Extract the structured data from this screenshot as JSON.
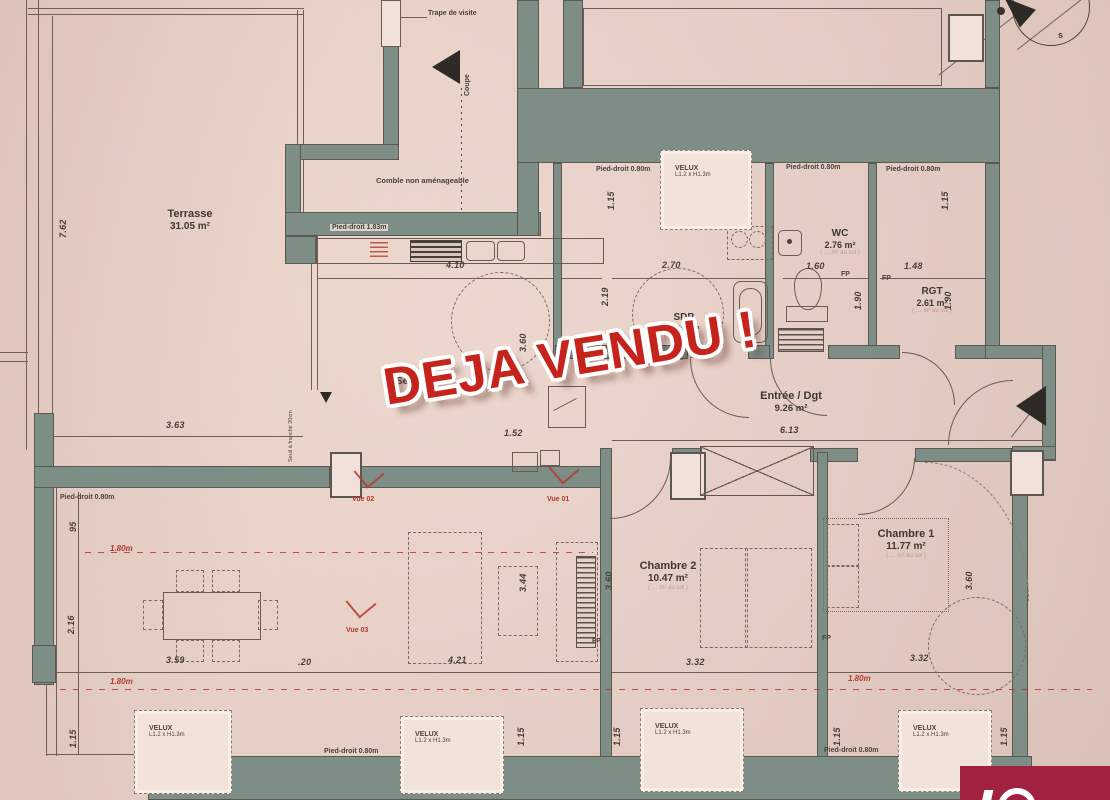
{
  "stamp": {
    "text": "DEJA VENDU !",
    "color": "#c5231c"
  },
  "compass": {
    "south": "s"
  },
  "rooms": {
    "terrasse": {
      "name": "Terrasse",
      "area": "31.05 m²"
    },
    "sejour": {
      "name": "Séjour"
    },
    "sdb": {
      "name": "SDB",
      "area": "5.48 m²"
    },
    "wc": {
      "name": "WC",
      "area": "2.76 m²"
    },
    "rgt": {
      "name": "RGT",
      "area": "2.61 m²"
    },
    "entree": {
      "name": "Entrée / Dgt",
      "area": "9.26 m²"
    },
    "chambre2": {
      "name": "Chambre 2",
      "area": "10.47 m²"
    },
    "chambre1": {
      "name": "Chambre 1",
      "area": "11.77 m²"
    }
  },
  "notes": {
    "trape": "Trape de visite",
    "coupe": "Coupe",
    "comble": "Comble non aménageable",
    "pied_droit_haut": "Pied-droit 1.83m",
    "seuil": "Seuil à franchir 20cm",
    "au_sol": "( … m² au sol )"
  },
  "velux": {
    "label": "VELUX",
    "size": "L1.2 x H1.3m",
    "boxes": [
      {
        "x": 660,
        "y": 150,
        "w": 90,
        "h": 78
      },
      {
        "x": 134,
        "y": 710,
        "w": 96,
        "h": 82
      },
      {
        "x": 400,
        "y": 716,
        "w": 102,
        "h": 76
      },
      {
        "x": 640,
        "y": 708,
        "w": 102,
        "h": 82
      },
      {
        "x": 898,
        "y": 710,
        "w": 92,
        "h": 80
      }
    ]
  },
  "pied_droit": {
    "label": "Pied-droit 0.80m",
    "positions": [
      {
        "x": 596,
        "y": 166
      },
      {
        "x": 786,
        "y": 164
      },
      {
        "x": 886,
        "y": 166
      },
      {
        "x": 60,
        "y": 494
      },
      {
        "x": 324,
        "y": 748
      },
      {
        "x": 824,
        "y": 747
      }
    ]
  },
  "fp": {
    "label": "FP",
    "positions": [
      {
        "x": 841,
        "y": 271
      },
      {
        "x": 882,
        "y": 275
      },
      {
        "x": 592,
        "y": 638
      },
      {
        "x": 822,
        "y": 635
      }
    ]
  },
  "height_lines": {
    "label": "1.80m",
    "positions": [
      {
        "x": 110,
        "y": 544
      },
      {
        "x": 110,
        "y": 677
      },
      {
        "x": 848,
        "y": 674
      }
    ]
  },
  "vues": [
    {
      "label": "Vue 02",
      "x": 352,
      "y": 496,
      "sx": 358,
      "sy": 462
    },
    {
      "label": "Vue 01",
      "x": 547,
      "y": 496,
      "sx": 553,
      "sy": 458
    },
    {
      "label": "Vue 03",
      "x": 346,
      "y": 627,
      "sx": 350,
      "sy": 592
    }
  ],
  "dims": [
    {
      "t": "7.62",
      "x": 58,
      "y": 238,
      "r": -90
    },
    {
      "t": "3.63",
      "x": 166,
      "y": 420,
      "r": 0
    },
    {
      "t": "4.10",
      "x": 446,
      "y": 260,
      "r": 0
    },
    {
      "t": "3.60",
      "x": 518,
      "y": 352,
      "r": -90
    },
    {
      "t": "2.19",
      "x": 600,
      "y": 306,
      "r": -90
    },
    {
      "t": "2.70",
      "x": 662,
      "y": 260,
      "r": 0
    },
    {
      "t": "1.15",
      "x": 606,
      "y": 210,
      "r": -90
    },
    {
      "t": "1.60",
      "x": 806,
      "y": 261,
      "r": 0
    },
    {
      "t": "1.90",
      "x": 853,
      "y": 310,
      "r": -90
    },
    {
      "t": "1.48",
      "x": 904,
      "y": 261,
      "r": 0
    },
    {
      "t": "1.90",
      "x": 943,
      "y": 310,
      "r": -90
    },
    {
      "t": "1.15",
      "x": 940,
      "y": 210,
      "r": -90
    },
    {
      "t": "6.13",
      "x": 780,
      "y": 425,
      "r": 0
    },
    {
      "t": "1.52",
      "x": 504,
      "y": 428,
      "r": 0
    },
    {
      "t": "95",
      "x": 68,
      "y": 532,
      "r": -90
    },
    {
      "t": "2.16",
      "x": 66,
      "y": 634,
      "r": -90
    },
    {
      "t": "1.15",
      "x": 68,
      "y": 748,
      "r": -90
    },
    {
      "t": "3.59",
      "x": 166,
      "y": 655,
      "r": 0
    },
    {
      "t": ".20",
      "x": 298,
      "y": 657,
      "r": 0
    },
    {
      "t": "4.21",
      "x": 448,
      "y": 655,
      "r": 0
    },
    {
      "t": "3.44",
      "x": 518,
      "y": 592,
      "r": -90
    },
    {
      "t": "3.60",
      "x": 604,
      "y": 590,
      "r": -90
    },
    {
      "t": "3.32",
      "x": 686,
      "y": 657,
      "r": 0
    },
    {
      "t": "3.60",
      "x": 964,
      "y": 590,
      "r": -90
    },
    {
      "t": "3.32",
      "x": 910,
      "y": 653,
      "r": 0
    },
    {
      "t": "1.15",
      "x": 516,
      "y": 746,
      "r": -90
    },
    {
      "t": "1.15",
      "x": 612,
      "y": 746,
      "r": -90
    },
    {
      "t": "1.15",
      "x": 832,
      "y": 746,
      "r": -90
    },
    {
      "t": "1.15",
      "x": 999,
      "y": 746,
      "r": -90
    }
  ]
}
